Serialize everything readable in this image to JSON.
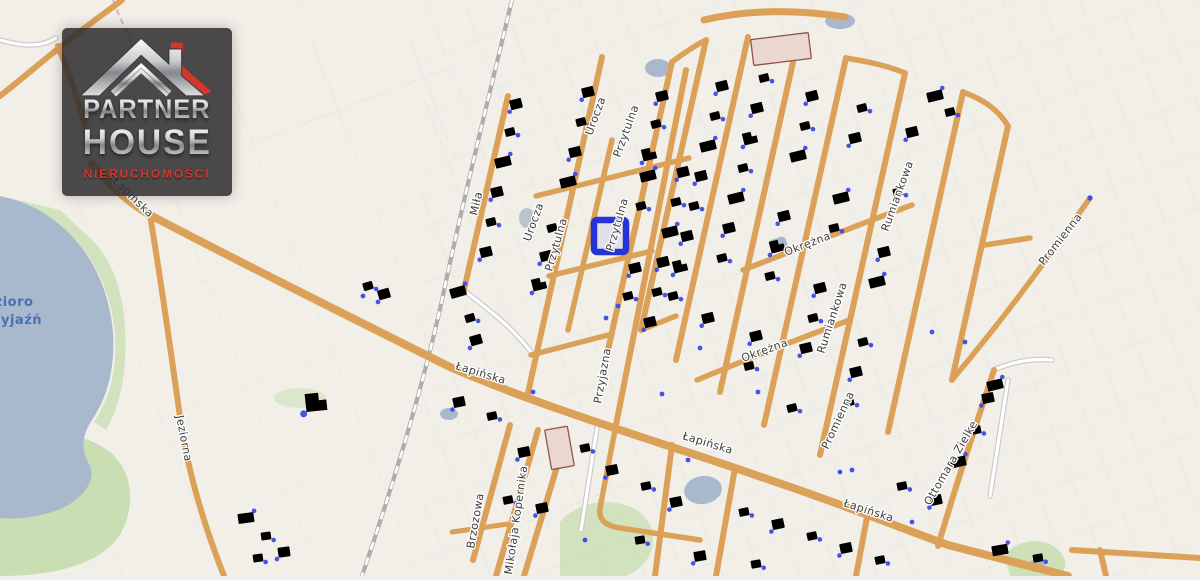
{
  "logo": {
    "line1": "PARTNER",
    "line2": "HOUSE",
    "line3": "NIERUCHOMOŚCI"
  },
  "lake_label": {
    "line1": "Jezioro",
    "line2": "Przyjaźń"
  },
  "streets": [
    {
      "name": "Łapińska"
    },
    {
      "name": "Łapińska"
    },
    {
      "name": "Łapińska"
    },
    {
      "name": "Łapińska"
    },
    {
      "name": "Jeziorna"
    },
    {
      "name": "Miła"
    },
    {
      "name": "Urocza"
    },
    {
      "name": "Urocza"
    },
    {
      "name": "Przytulna"
    },
    {
      "name": "Przytulna"
    },
    {
      "name": "Przytulna"
    },
    {
      "name": "Przyjazna"
    },
    {
      "name": "Okrężna"
    },
    {
      "name": "Okrężna"
    },
    {
      "name": "Rumiankowa"
    },
    {
      "name": "Rumiankowa"
    },
    {
      "name": "Promienna"
    },
    {
      "name": "Promienna"
    },
    {
      "name": "Brzozowa"
    },
    {
      "name": "Mikołaja Kopernika"
    },
    {
      "name": "Ottomara Zielke"
    }
  ],
  "colors": {
    "background": "#f2efe8",
    "road": "#dca158",
    "water": "#a9b9cd",
    "green": "#c9deb3",
    "building_fill": "#ead7cf",
    "building_stroke": "#90544b",
    "address_dot": "#3c4ae6",
    "plot_highlight": "#2733d6",
    "label": "#3c3c3c",
    "logo_red": "#d6352c"
  }
}
